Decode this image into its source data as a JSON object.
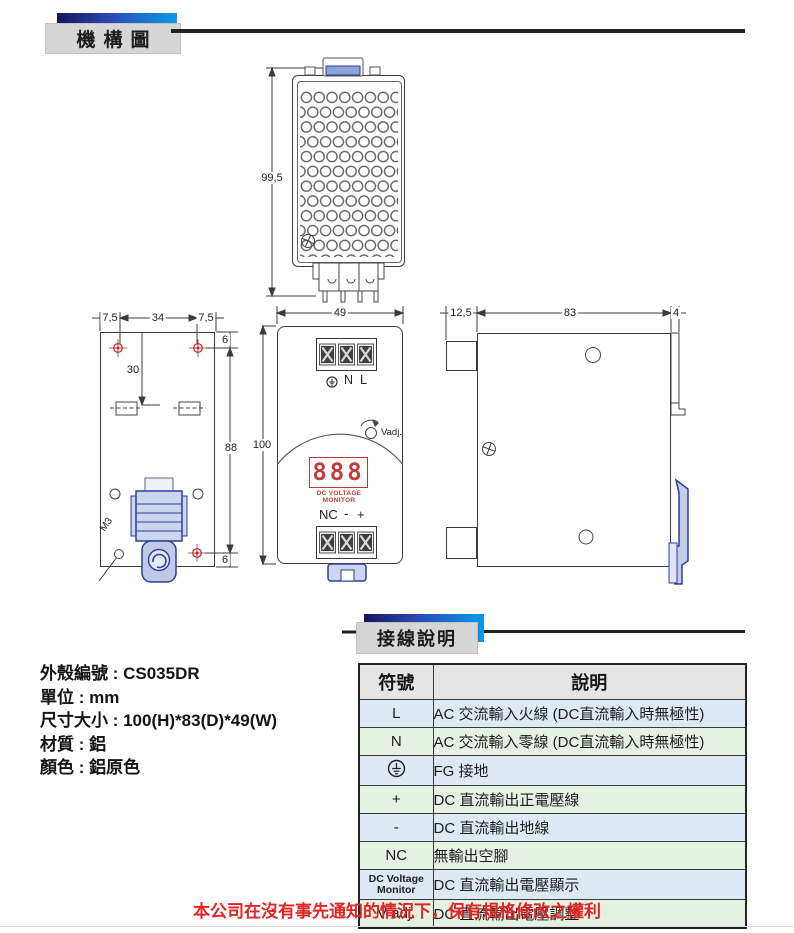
{
  "page": {
    "section1_title": "機構圖",
    "section2_title": "接線說明",
    "footer_note": "本公司在沒有事先通知的情況下，保有規格修改之權利",
    "accent_navy": "#16165c",
    "accent_blue": "#089ae8",
    "drawing_line_color": "#3a3a3a",
    "drawing_blue": "#2e3e96",
    "target_red": "#b5252a",
    "display_red": "#c43c3c"
  },
  "specs": {
    "lines": [
      "外殼編號 : CS035DR",
      "單位 : mm",
      "尺寸大小 : 100(H)*83(D)*49(W)",
      "材質 : 鋁",
      "顏色 : 鋁原色"
    ]
  },
  "drawings": {
    "top_view": {
      "dim_height": "99,5"
    },
    "rear_view": {
      "dim_left_margin": "7,5",
      "dim_hole_span": "34",
      "dim_right_margin": "7,5",
      "dim_top_offset": "6",
      "dim_hole_height": "88",
      "dim_bottom_offset": "6",
      "dim_slot_offset": "30",
      "thread_label": "M3"
    },
    "front_view": {
      "dim_width": "49",
      "dim_height": "100",
      "label_ground_icon": "earth-ground",
      "label_n": "N",
      "label_l": "L",
      "vadj_label": "Vadj.",
      "display_value": "888",
      "display_caption": "DC VOLTAGE MONITOR",
      "label_nc": "NC",
      "label_minus": "-",
      "label_plus": "+"
    },
    "side_view": {
      "dim_front_offset": "12,5",
      "dim_depth": "83",
      "dim_rail": "4"
    }
  },
  "wiring_table": {
    "headers": [
      "符號",
      "說明"
    ],
    "tint_blue": "#ddeaf6",
    "tint_green": "#e5f1e2",
    "header_bg": "#e5e5e5",
    "rows": [
      {
        "symbol": "L",
        "desc": "AC 交流輸入火線 (DC直流輸入時無極性)"
      },
      {
        "symbol": "N",
        "desc": "AC 交流輸入零線 (DC直流輸入時無極性)"
      },
      {
        "symbol": "earth-ground-icon",
        "desc": "FG 接地"
      },
      {
        "symbol": "+",
        "desc": "DC 直流輸出正電壓線"
      },
      {
        "symbol": "-",
        "desc": "DC 直流輸出地線"
      },
      {
        "symbol": "NC",
        "desc": "無輸出空腳"
      },
      {
        "symbol": "DC Voltage Monitor",
        "desc": "DC 直流輸出電壓顯示"
      },
      {
        "symbol": "V adj.",
        "desc": "DC 直流輸出電壓調整"
      }
    ]
  }
}
